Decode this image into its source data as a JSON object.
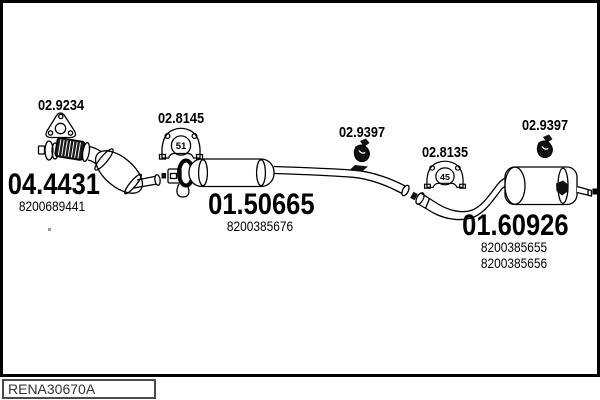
{
  "footer": {
    "code": "RENA30670A"
  },
  "callouts": {
    "gasket_label": "02.9234",
    "front_hanger_label": "02.8145",
    "front_hanger_size": "51",
    "mid_mount_label": "02.9397",
    "rear_clamp_label": "02.8135",
    "rear_clamp_size": "45",
    "rear_mount_label": "02.9397"
  },
  "parts": {
    "front_pipe_catalyst": {
      "code": "04.4431",
      "ref1": "8200689441"
    },
    "centre_muffler": {
      "code": "01.50665",
      "ref1": "8200385676"
    },
    "rear_muffler": {
      "code": "01.60926",
      "ref1": "8200385655",
      "ref2": "8200385656"
    }
  },
  "colors": {
    "line": "#000000",
    "background": "#ffffff",
    "fill_dark": "#111111"
  }
}
